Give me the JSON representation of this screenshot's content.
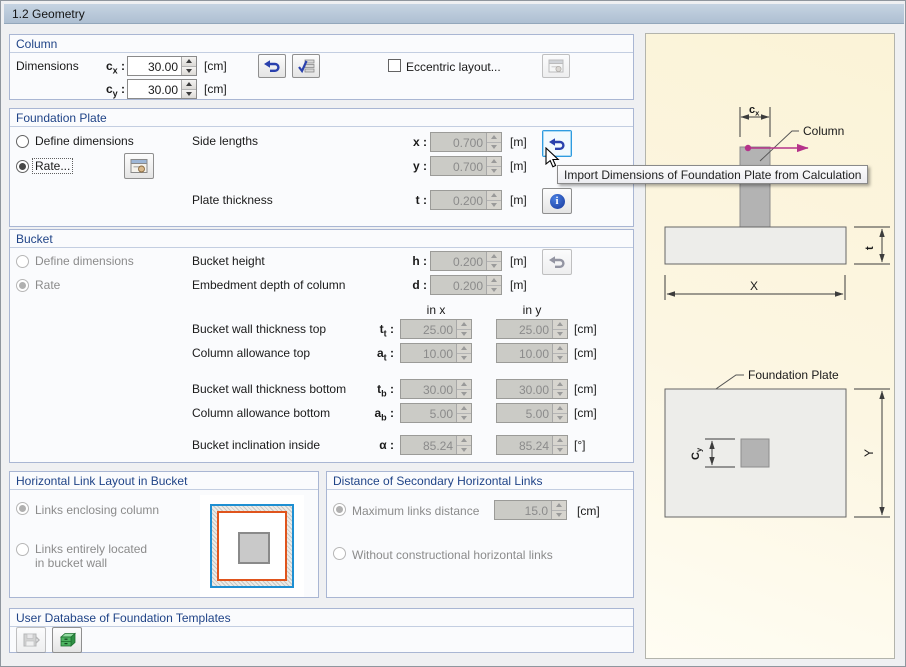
{
  "title": "1.2 Geometry",
  "colors": {
    "titlebar": "#b7c7d7",
    "group_border": "#a9b6d3",
    "header_text": "#1f4387",
    "panel_bg": "#fbf3d7",
    "accent_orange": "#e0541c",
    "accent_blue": "#1e8fd2",
    "magenta_axis": "#b5338a",
    "highlight_border": "#2f9be0"
  },
  "icons": {
    "import": "import-arrow-icon",
    "check_list": "check-list-icon",
    "edit_window": "window-edit-icon",
    "info": "info-icon",
    "save": "save-template-icon",
    "database": "database-icon"
  },
  "column": {
    "header": "Column",
    "dimensions_label": "Dimensions",
    "cx": {
      "base": "c",
      "sub": "x",
      "colon": " :",
      "value": "30.00",
      "unit": "[cm]"
    },
    "cy": {
      "base": "c",
      "sub": "y",
      "colon": " :",
      "value": "30.00",
      "unit": "[cm]"
    },
    "eccentric_label": "Eccentric layout..."
  },
  "foundation_plate": {
    "header": "Foundation Plate",
    "define_dimensions": "Define dimensions",
    "rate": "Rate...",
    "side_lengths": "Side lengths",
    "x_sym": "x :",
    "x_value": "0.700",
    "x_unit": "[m]",
    "y_sym": "y :",
    "y_value": "0.700",
    "y_unit": "[m]",
    "plate_thickness": "Plate thickness",
    "t_sym": "t :",
    "t_value": "0.200",
    "t_unit": "[m]"
  },
  "bucket": {
    "header": "Bucket",
    "define_dimensions": "Define dimensions",
    "rate": "Rate",
    "height_label": "Bucket height",
    "h_sym": "h :",
    "h_value": "0.200",
    "h_unit": "[m]",
    "embed_label": "Embedment depth of column",
    "d_sym": "d :",
    "d_value": "0.200",
    "d_unit": "[m]",
    "col_in_x": "in x",
    "col_in_y": "in y",
    "rows": [
      {
        "label": "Bucket wall thickness top",
        "sym": {
          "base": "t",
          "sub": "t",
          "colon": " :"
        },
        "vx": "25.00",
        "vy": "25.00",
        "unit": "[cm]"
      },
      {
        "label": "Column allowance top",
        "sym": {
          "base": "a",
          "sub": "t",
          "colon": " :"
        },
        "vx": "10.00",
        "vy": "10.00",
        "unit": "[cm]"
      },
      {
        "label": "Bucket wall thickness bottom",
        "sym": {
          "base": "t",
          "sub": "b",
          "colon": " :"
        },
        "vx": "30.00",
        "vy": "30.00",
        "unit": "[cm]"
      },
      {
        "label": "Column allowance bottom",
        "sym": {
          "base": "a",
          "sub": "b",
          "colon": " :"
        },
        "vx": "5.00",
        "vy": "5.00",
        "unit": "[cm]"
      },
      {
        "label": "Bucket inclination inside",
        "sym": {
          "base": "α",
          "sub": "",
          "colon": " :"
        },
        "vx": "85.24",
        "vy": "85.24",
        "unit": "[°]"
      }
    ]
  },
  "link_layout": {
    "header": "Horizontal Link Layout in Bucket",
    "opt1": "Links enclosing column",
    "opt2_line1": "Links entirely located",
    "opt2_line2": "in bucket wall"
  },
  "secondary_links": {
    "header": "Distance of Secondary Horizontal Links",
    "opt1": "Maximum links distance",
    "value": "15.0",
    "unit": "[cm]",
    "opt2": "Without constructional horizontal links"
  },
  "user_db": {
    "header": "User Database of Foundation Templates"
  },
  "tooltip": {
    "text": "Import Dimensions of Foundation Plate from Calculation"
  },
  "diagram": {
    "column_label": "Column",
    "foundation_plate_label": "Foundation Plate",
    "cx": {
      "base": "c",
      "sub": "x"
    },
    "cy": {
      "base": "C",
      "sub": "y"
    },
    "x_label": "X",
    "y_label": "Y",
    "t_label": "t"
  }
}
